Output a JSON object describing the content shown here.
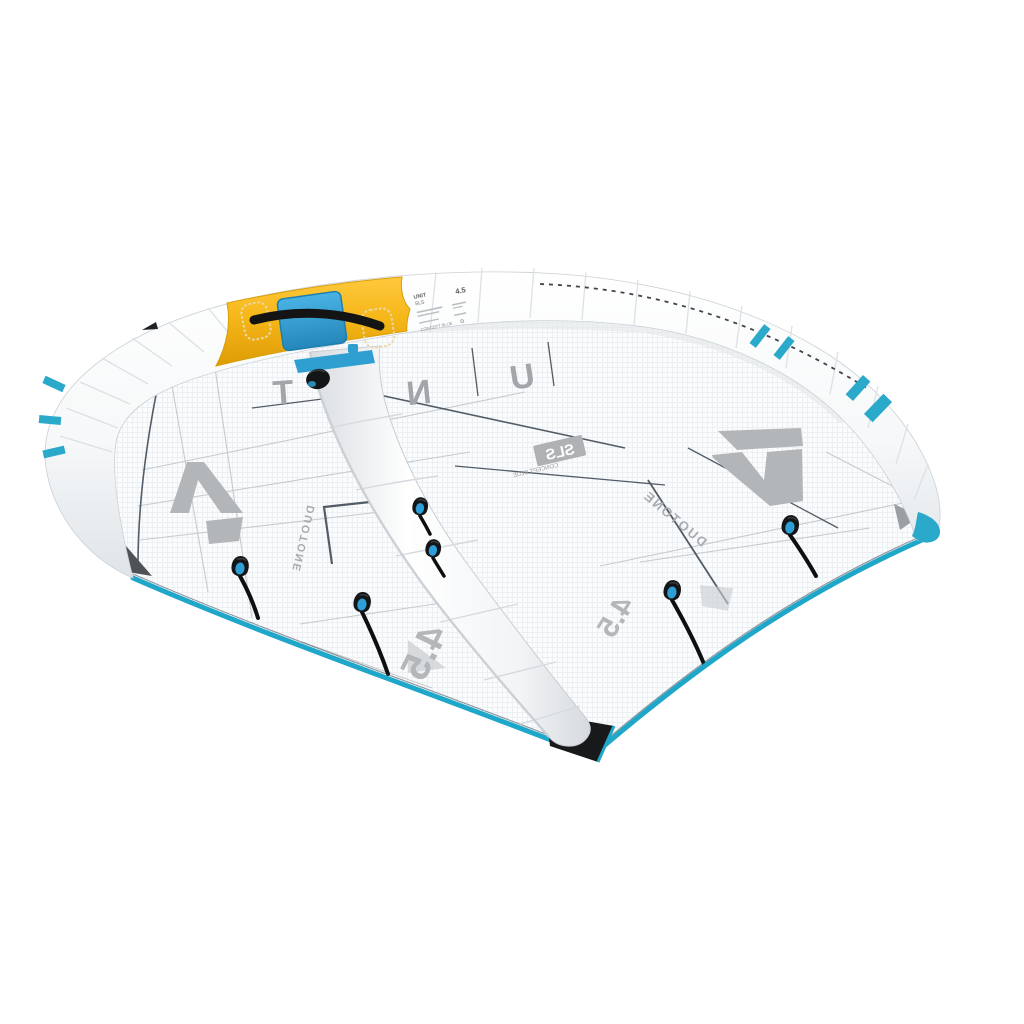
{
  "image": {
    "type": "product-photo",
    "subject": "Inflatable wing (wing-foil wing) seen from behind, white canopy, yellow handle segment on leading edge, teal trailing edge",
    "background_color": "#FFFFFF"
  },
  "colors": {
    "trailing_edge_teal": "#1FA7C9",
    "accent_cyan": "#3BA8DC",
    "handle_segment_yellow": "#F6B719",
    "canopy_white": "#FBFCFD",
    "seam_navy": "#35424E",
    "print_gray": "#A8ACB0",
    "knob_black": "#141516"
  },
  "spec_label": {
    "product": "UNIT",
    "edition": "SLS",
    "size": "4.5",
    "footer": "CONCEPT BLUE",
    "gear_icon": "⚙"
  },
  "canopy": {
    "word": "UNIT",
    "letters_visible": [
      "T",
      "N",
      "U"
    ],
    "sls_badge": "SLS",
    "sls_subtext": "CONCEPT BLUE",
    "brand_left": "DUOTONE",
    "brand_right": "DUOTONE",
    "size_mark_left": "4.5",
    "size_mark_right": "4.5"
  }
}
